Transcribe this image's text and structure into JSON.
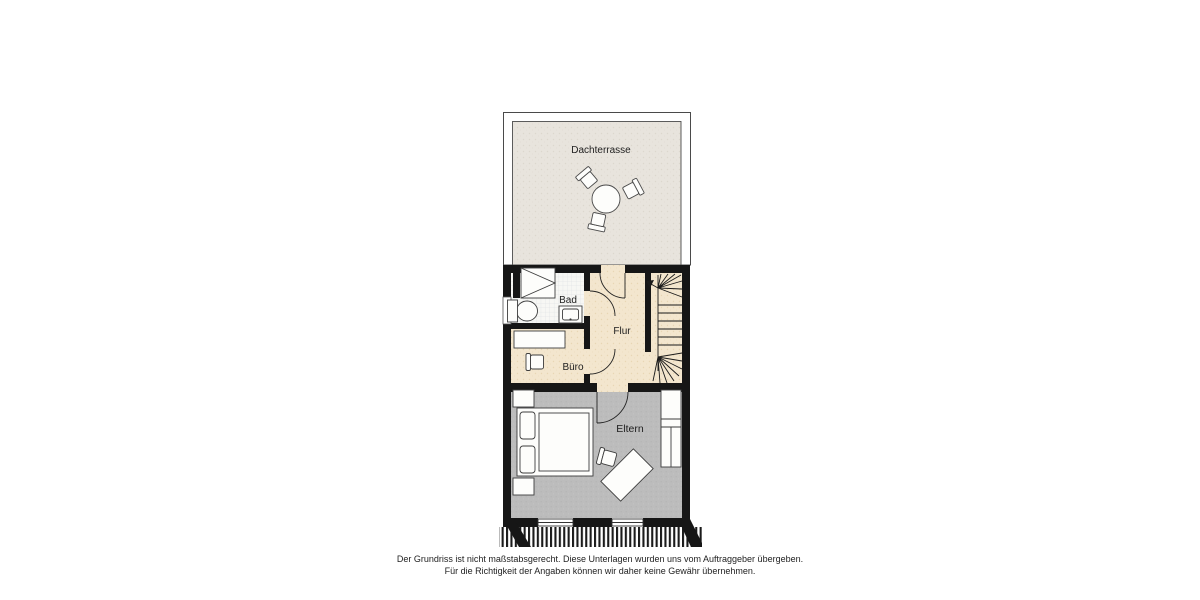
{
  "floorplan": {
    "rooms": {
      "terrace": {
        "label": "Dachterrasse"
      },
      "bath": {
        "label": "Bad"
      },
      "hall": {
        "label": "Flur"
      },
      "office": {
        "label": "Büro"
      },
      "parents": {
        "label": "Eltern"
      }
    },
    "furniture_icons": [
      "round-table",
      "chair",
      "shower",
      "toilet",
      "sink",
      "desk",
      "office-chair",
      "double-bed",
      "nightstand",
      "wardrobe",
      "staircase",
      "window",
      "roof-edge-hatching"
    ],
    "colors": {
      "wall": "#161616",
      "wood_floor": "#f3e6ce",
      "tile_floor": "#f7f7f4",
      "carpet_floor": "#bcbcbc",
      "terrace_floor": "#e8e4dd",
      "furniture_outline": "#3d3d3d"
    }
  },
  "footer": {
    "line1": "Der Grundriss ist nicht maßstabsgerecht. Diese Unterlagen wurden uns vom Auftraggeber übergeben.",
    "line2": "Für die Richtigkeit der Angaben können wir daher keine Gewähr übernehmen."
  }
}
